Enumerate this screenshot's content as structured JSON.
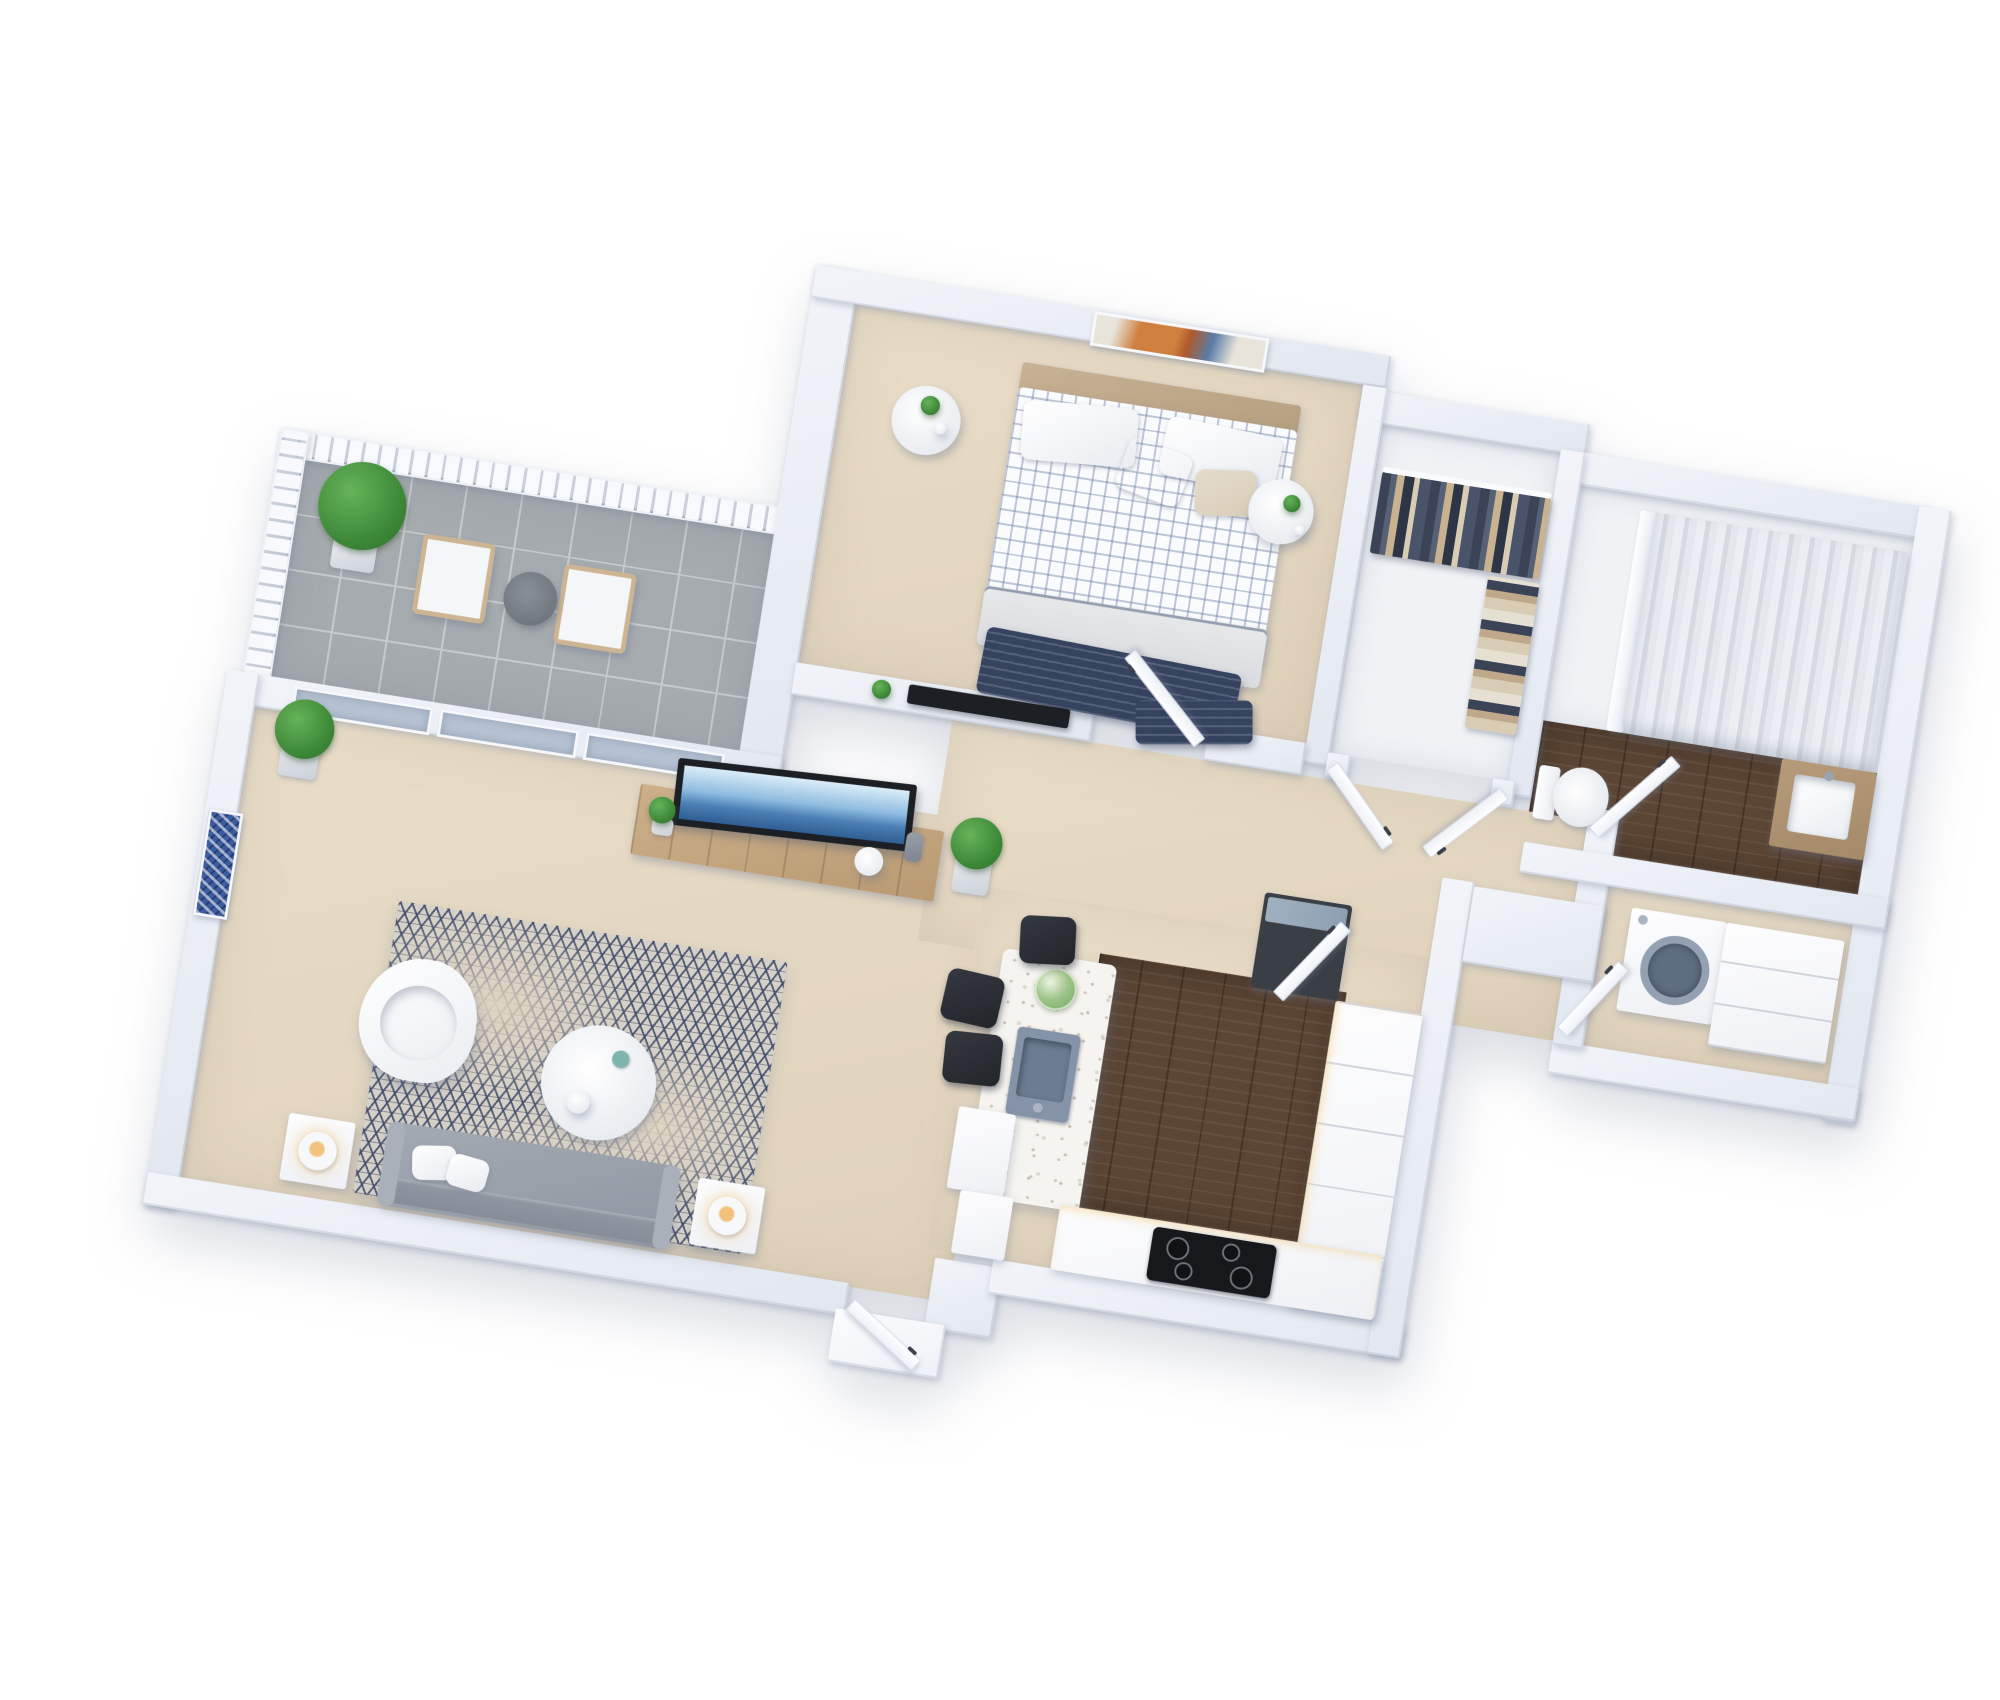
{
  "meta": {
    "type": "3d-floor-plan-rendering",
    "view": "isometric-top-down",
    "background": "#ffffff",
    "text_labels": []
  },
  "palette": {
    "wall-face": "#f2f4f9",
    "wall-shade": "#e2e7f0",
    "wall-edge": "#aeb7c8",
    "beige-a": "#e9ddc9",
    "beige-b": "#dfd1ba",
    "tile": "#a6abaf",
    "tile-line": "#c8cbce",
    "wood": "#5b4534",
    "wood-oak": "#cdb08a",
    "vanity-wood": "#b59b79",
    "terrazzo": "#f6f4f0",
    "speckle": "#cdc6ba",
    "rug-base": "#d6d1c8",
    "rug-navy": "#3e4a68",
    "navy": "#36435f",
    "blanket": "#d9dbde",
    "headboard": "#c8b295",
    "pillow-beige": "#d8cdb9",
    "green-a": "#67b35a",
    "green-b": "#2f6e2c",
    "pot-a": "#eceef2",
    "pot-b": "#ccd1d9",
    "curtain-a": "#eceef3",
    "curtain-b": "#d5d9e1",
    "ocean-a": "#dbedf8",
    "ocean-b": "#8fbce0",
    "ocean-c": "#2e5e94",
    "tv-black": "#1c1f24",
    "steel-a": "#8493a7",
    "steel-b": "#6c7d92",
    "stool-a": "#34383f",
    "stool-b": "#22252a",
    "fridge-body": "#3a3e45",
    "fridge-top": "#9fb0c0",
    "lamp-warm": "#f2c27d",
    "art-blue": "#3d5c9e",
    "art-orange": "#cf7f3e",
    "art-rust": "#b05a2c",
    "door-face": "#fdfeff",
    "door-edge": "#d8dee8",
    "glass": "#b6c3d3",
    "sofa-a": "#a3aab4",
    "sofa-b": "#8f96a1"
  },
  "rooms": [
    {
      "name": "balcony",
      "floor": "gray-tile",
      "items": [
        "railing",
        "potted-plant",
        "armchair",
        "armchair",
        "round-side-table"
      ]
    },
    {
      "name": "living-room",
      "floor": "beige-carpet",
      "items": [
        "sliding-glass-door",
        "corner-potted-plant",
        "blue-wall-art",
        "white-swivel-armchair",
        "patterned-rug",
        "round-coffee-table",
        "gray-sofa",
        "throw-pillows",
        "side-table-with-lamp",
        "side-table-with-lamp",
        "wood-tv-sideboard",
        "television-ocean-picture",
        "potted-plant"
      ]
    },
    {
      "name": "bedroom",
      "floor": "beige-carpet",
      "items": [
        "abstract-wall-art",
        "tan-headboard",
        "double-bed-checkered-duvet",
        "white-pillows",
        "navy-accent-pillow",
        "beige-pillow",
        "gray-blanket",
        "navy-striped-throw",
        "round-nightstand-with-plant",
        "round-nightstand-with-plant",
        "tv-on-half-wall",
        "ledge-plant"
      ]
    },
    {
      "name": "walk-in-closet",
      "floor": "white",
      "items": [
        "hanging-clothes-rail",
        "folded-clothes-shelf",
        "double-doors"
      ]
    },
    {
      "name": "bathroom",
      "floor": "dark-wood",
      "items": [
        "shower",
        "white-shower-curtain",
        "wood-vanity-square-sink",
        "toilet"
      ]
    },
    {
      "name": "laundry-room",
      "floor": "beige",
      "items": [
        "front-load-washing-machine",
        "counter-cabinet"
      ]
    },
    {
      "name": "hallway",
      "floor": "beige-carpet",
      "items": [
        "open-door",
        "open-door",
        "open-door",
        "open-door",
        "open-door"
      ]
    },
    {
      "name": "kitchen",
      "floor": "dark-wood",
      "items": [
        "terrazzo-island",
        "inset-steel-sink",
        "flower-bouquet",
        "bar-stool",
        "bar-stool",
        "bar-stool",
        "fridge-glass-top",
        "counter-run-with-drawers",
        "induction-cooktop",
        "cabinet-blocks"
      ]
    },
    {
      "name": "entry",
      "floor": "beige-carpet",
      "items": [
        "entry-door",
        "threshold-step"
      ]
    }
  ]
}
